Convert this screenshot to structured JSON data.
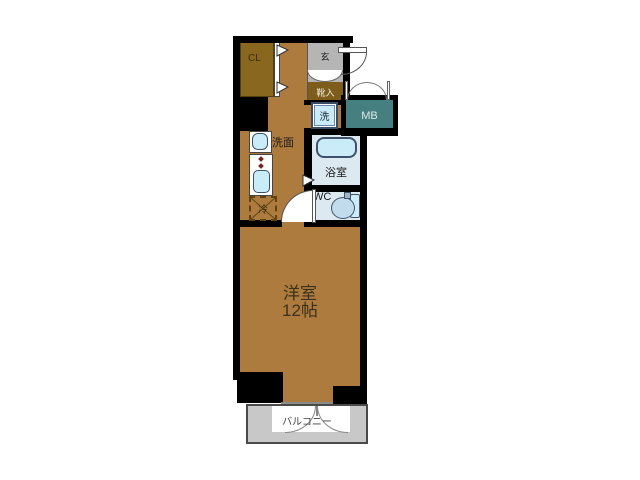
{
  "plan": {
    "labels": {
      "closet": "CL",
      "entrance": "玄",
      "shoe_box": "靴入",
      "washer": "洗",
      "meter_box": "MB",
      "washstand": "洗面",
      "bathroom": "浴室",
      "toilet": "WC",
      "refrigerator": "冷",
      "main_room_name": "洋室",
      "main_room_size": "12帖",
      "balcony": "バルコニー"
    },
    "colors": {
      "wall": "#000000",
      "room-floor": "#ad7b3e",
      "closet-floor": "#8a671f",
      "shoebox-fill": "#7d5c1c",
      "genkan-floor": "#b5b5b5",
      "meterbox-fill": "#467f7f",
      "fixture-blue": "#c9ecf8",
      "bath-floor": "#dce9f0",
      "balcony-floor": "#c8c8c8",
      "toilet-bowl": "#c2dbed",
      "burner-red": "#7a1f1f",
      "outline": "#444444"
    }
  }
}
